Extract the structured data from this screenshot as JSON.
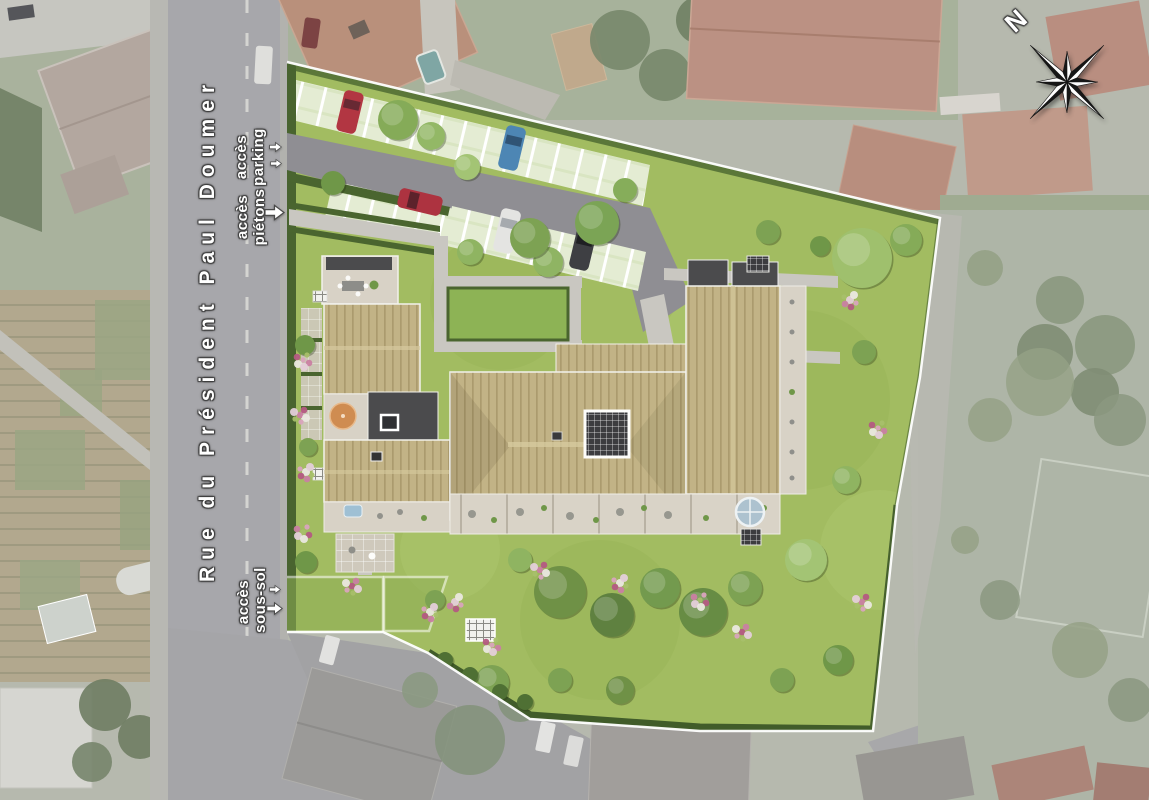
{
  "street": {
    "name": "Rue du Président Paul Doumer"
  },
  "access_labels": {
    "parking": {
      "line1": "accès",
      "line2": "parking"
    },
    "pietons": {
      "line1": "accès",
      "line2": "piétons"
    },
    "sous_sol": {
      "line1": "accès",
      "line2": "sous-sol"
    }
  },
  "compass": {
    "north": "N"
  },
  "site_plan": {
    "type": "aerial residential development site plan render",
    "cars_in_parking": [
      "red",
      "blue",
      "white",
      "dark-gray",
      "red"
    ],
    "colors": {
      "site_lawn": "#a2bc61",
      "roof_wood": "#c2b386",
      "roof_slate": "#4b4b4d",
      "terrace": "#d8d2c6",
      "parking_asphalt": "#8f8e93",
      "stall_pavers": "#e4ecd3",
      "boundary_line": "#ffffff",
      "road": "#a7a7ab",
      "hedge": "#4a652f"
    }
  }
}
